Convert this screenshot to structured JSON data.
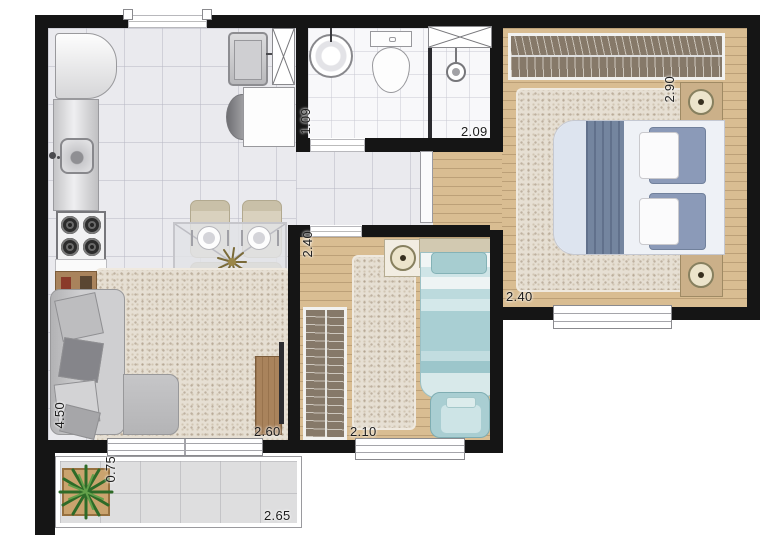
{
  "plan_title": "apartment-floor-plan",
  "labels": {
    "bath_corridor_width": "1.09",
    "bath_length": "2.09",
    "master_length": "2.90",
    "master_width": "2.40",
    "bedroom2_length": "2.40",
    "bedroom2_width": "2.10",
    "tv_wall_width": "2.60",
    "living_length": "4.50",
    "balcony_depth": "0.75",
    "balcony_width": "2.65"
  },
  "colors": {
    "wall": "#151515",
    "tile_floor": "#eaeaee",
    "bath_floor": "#f8f8fa",
    "wood_floor": "#d9bd92",
    "rug": "#e6dfd3",
    "wardrobe": "#867969",
    "master_bed_blue": "#74859f",
    "single_bed_teal": "#a7cdd0",
    "sofa_gray": "#c4c4c6",
    "furniture_wood": "#a9835c",
    "plant_green": "#2e6b28"
  }
}
